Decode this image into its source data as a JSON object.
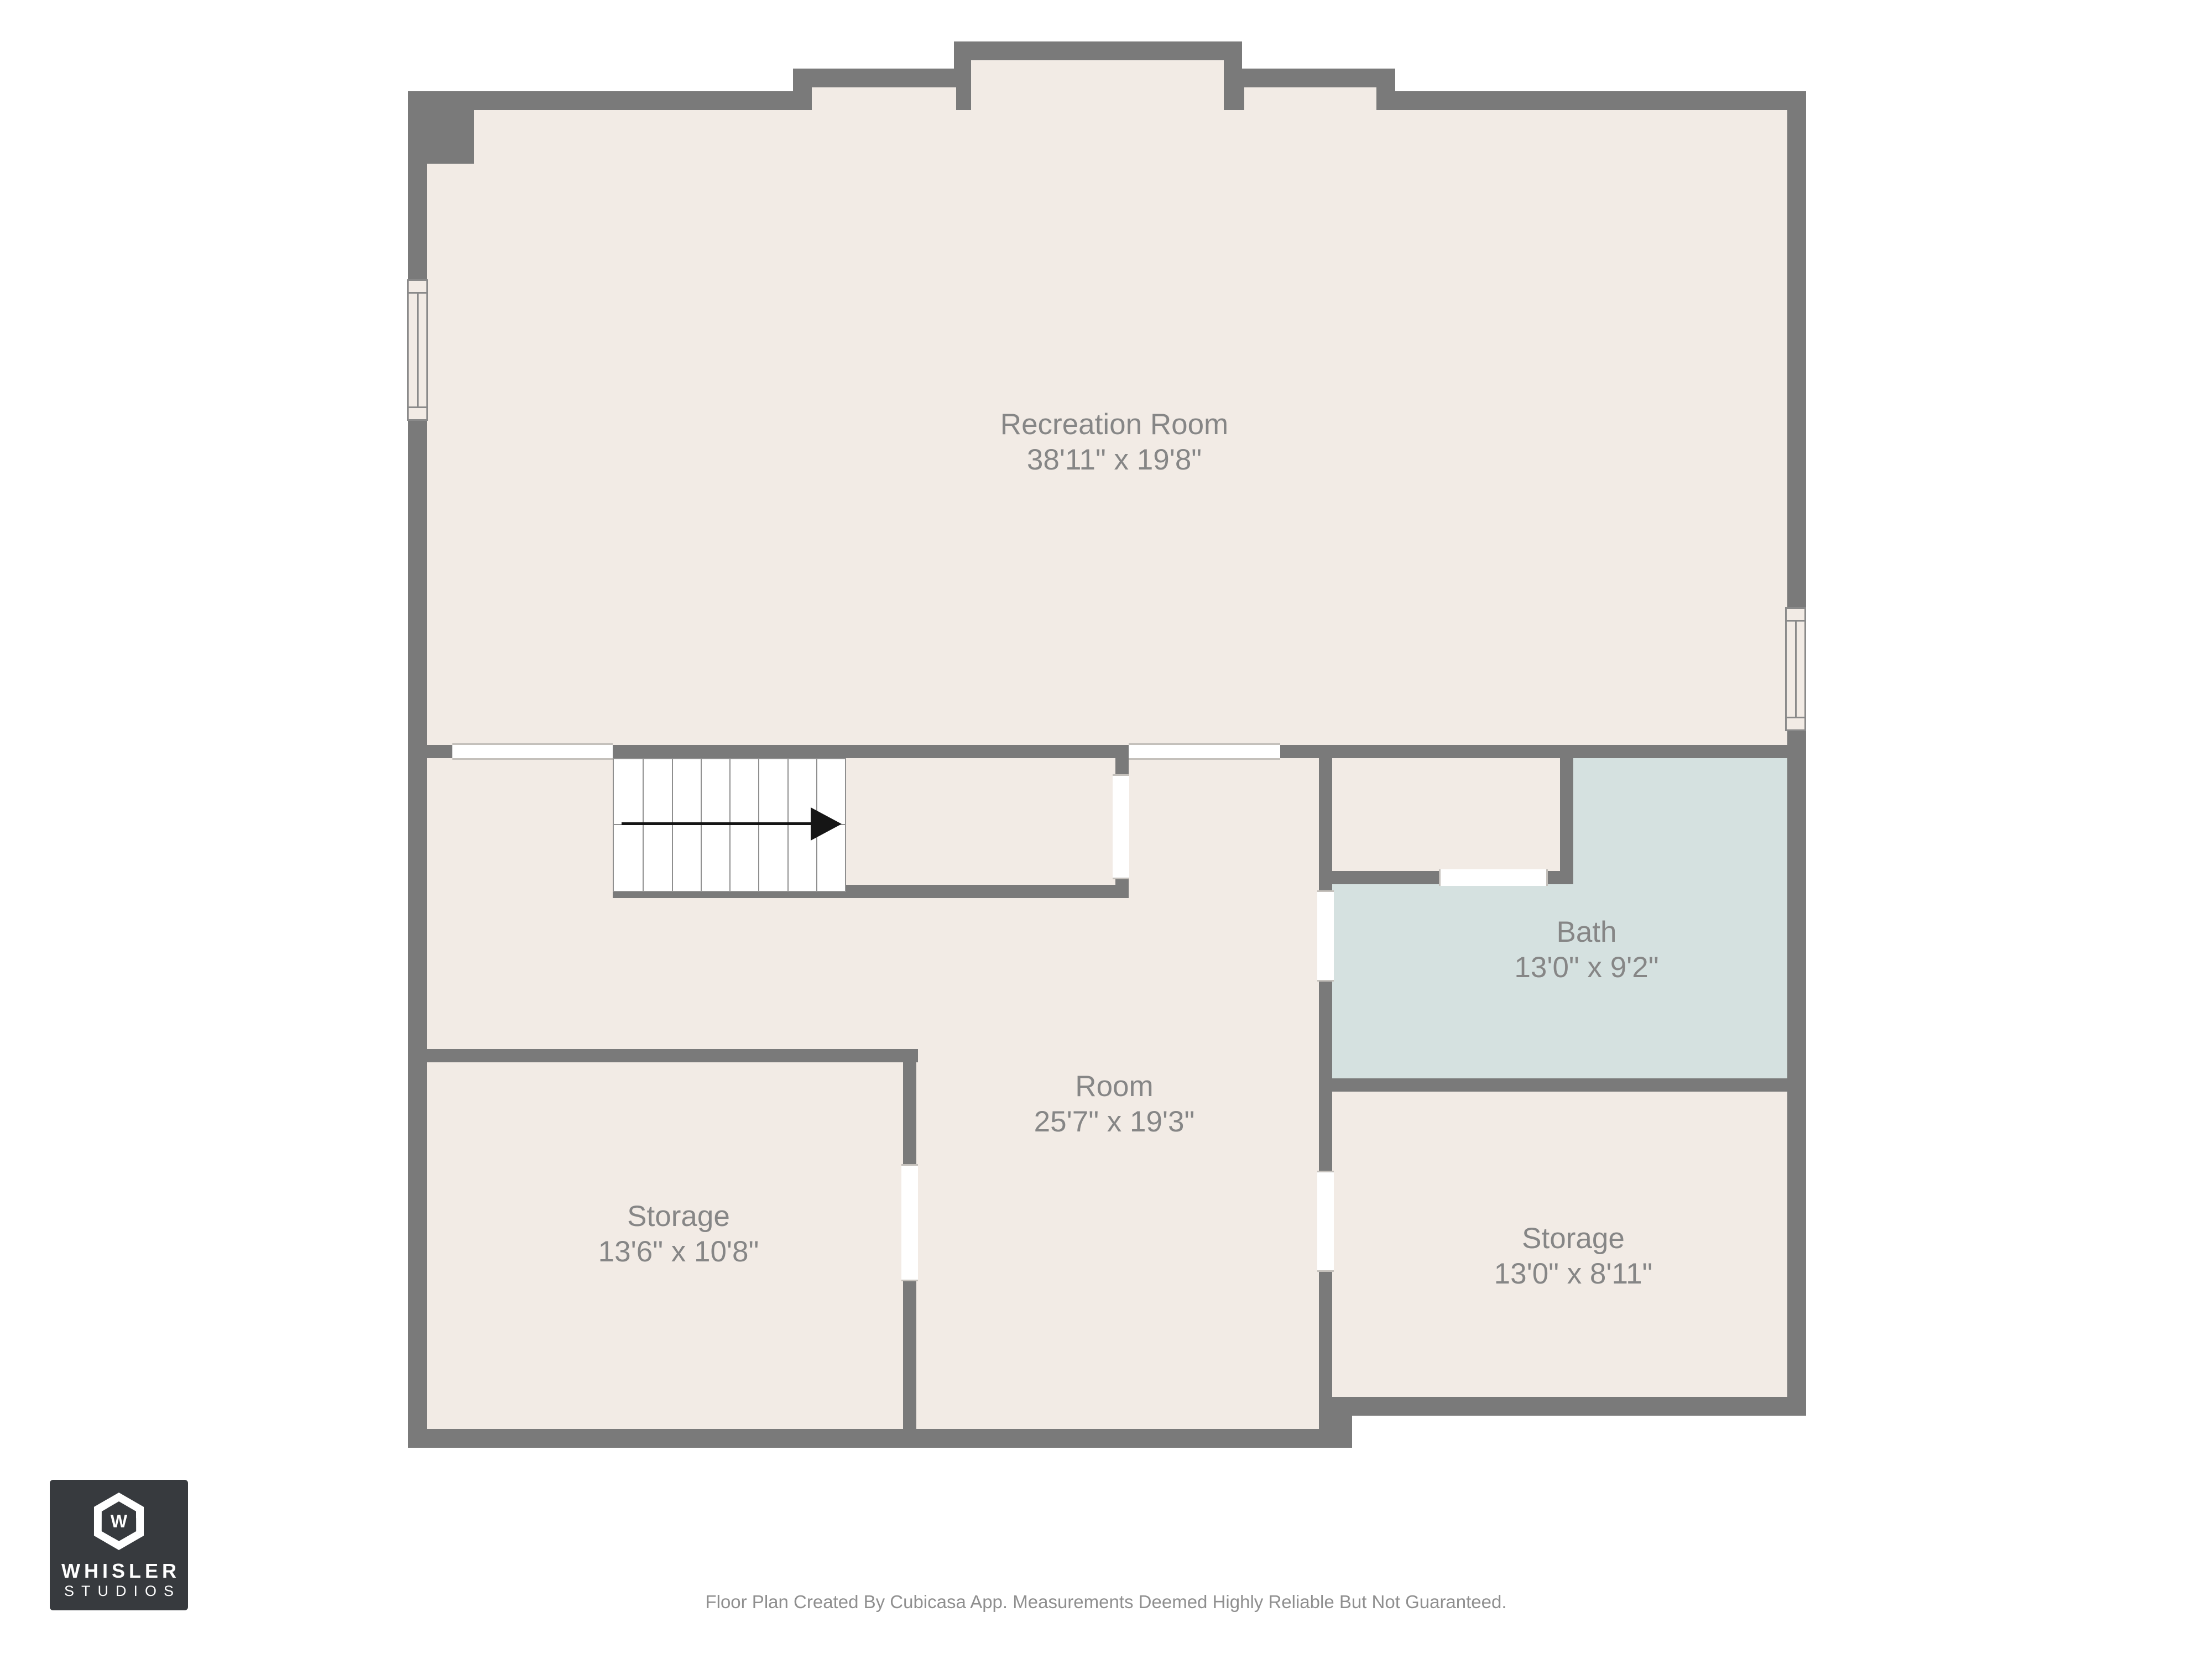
{
  "plan": {
    "colors": {
      "background": "#ffffff",
      "wall": "#7a7a7a",
      "floor": "#f2ebe5",
      "bath_floor": "#d5e1e0",
      "stair_line": "#8f8f8f",
      "label_text": "#868686",
      "arrow": "#151515",
      "opening_line": "#c4c0bb",
      "window_line": "#8a8a8a",
      "logo_bg": "#373a3e",
      "footer_text": "#8f8f8f"
    },
    "rooms": [
      {
        "name": "Recreation Room",
        "dims": "38'11\" x 19'8\""
      },
      {
        "name": "Room",
        "dims": "25'7\" x 19'3\""
      },
      {
        "name": "Bath",
        "dims": "13'0\" x 9'2\""
      },
      {
        "name": "Storage",
        "dims": "13'6\" x 10'8\""
      },
      {
        "name": "Storage",
        "dims": "13'0\" x 8'11\""
      }
    ],
    "stairs": {
      "treads": 8,
      "direction_arrow": "right"
    }
  },
  "logo": {
    "name": "WHISLER",
    "sub": "STUDIOS",
    "monogram": "W"
  },
  "footer": {
    "disclaimer": "Floor Plan Created By Cubicasa App. Measurements Deemed Highly Reliable But Not Guaranteed."
  }
}
